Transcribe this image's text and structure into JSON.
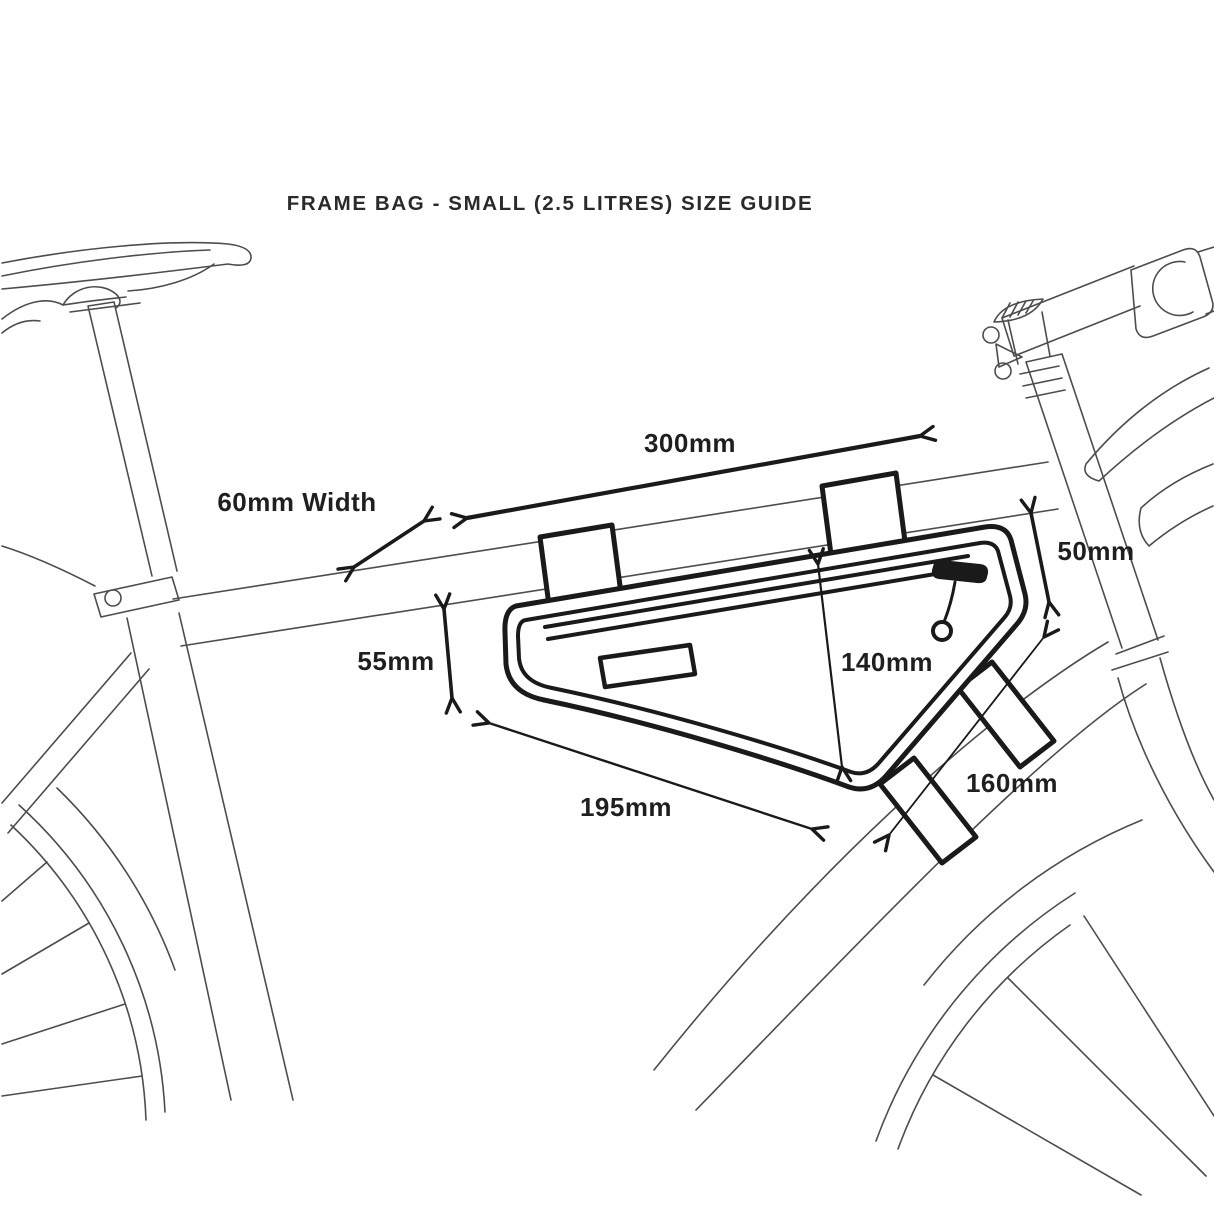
{
  "diagram": {
    "title": "FRAME BAG - SMALL (2.5 LITRES) SIZE GUIDE",
    "dimensions": {
      "top_length": "300mm",
      "bag_width": "60mm Width",
      "right_height": "50mm",
      "left_height": "55mm",
      "center_height": "140mm",
      "bottom_length": "195mm",
      "downtube_length": "160mm"
    },
    "colors": {
      "ink_bold": "#1a1a1a",
      "ink_thin": "#4d4d4d",
      "text": "#212121",
      "background": "#ffffff"
    }
  }
}
